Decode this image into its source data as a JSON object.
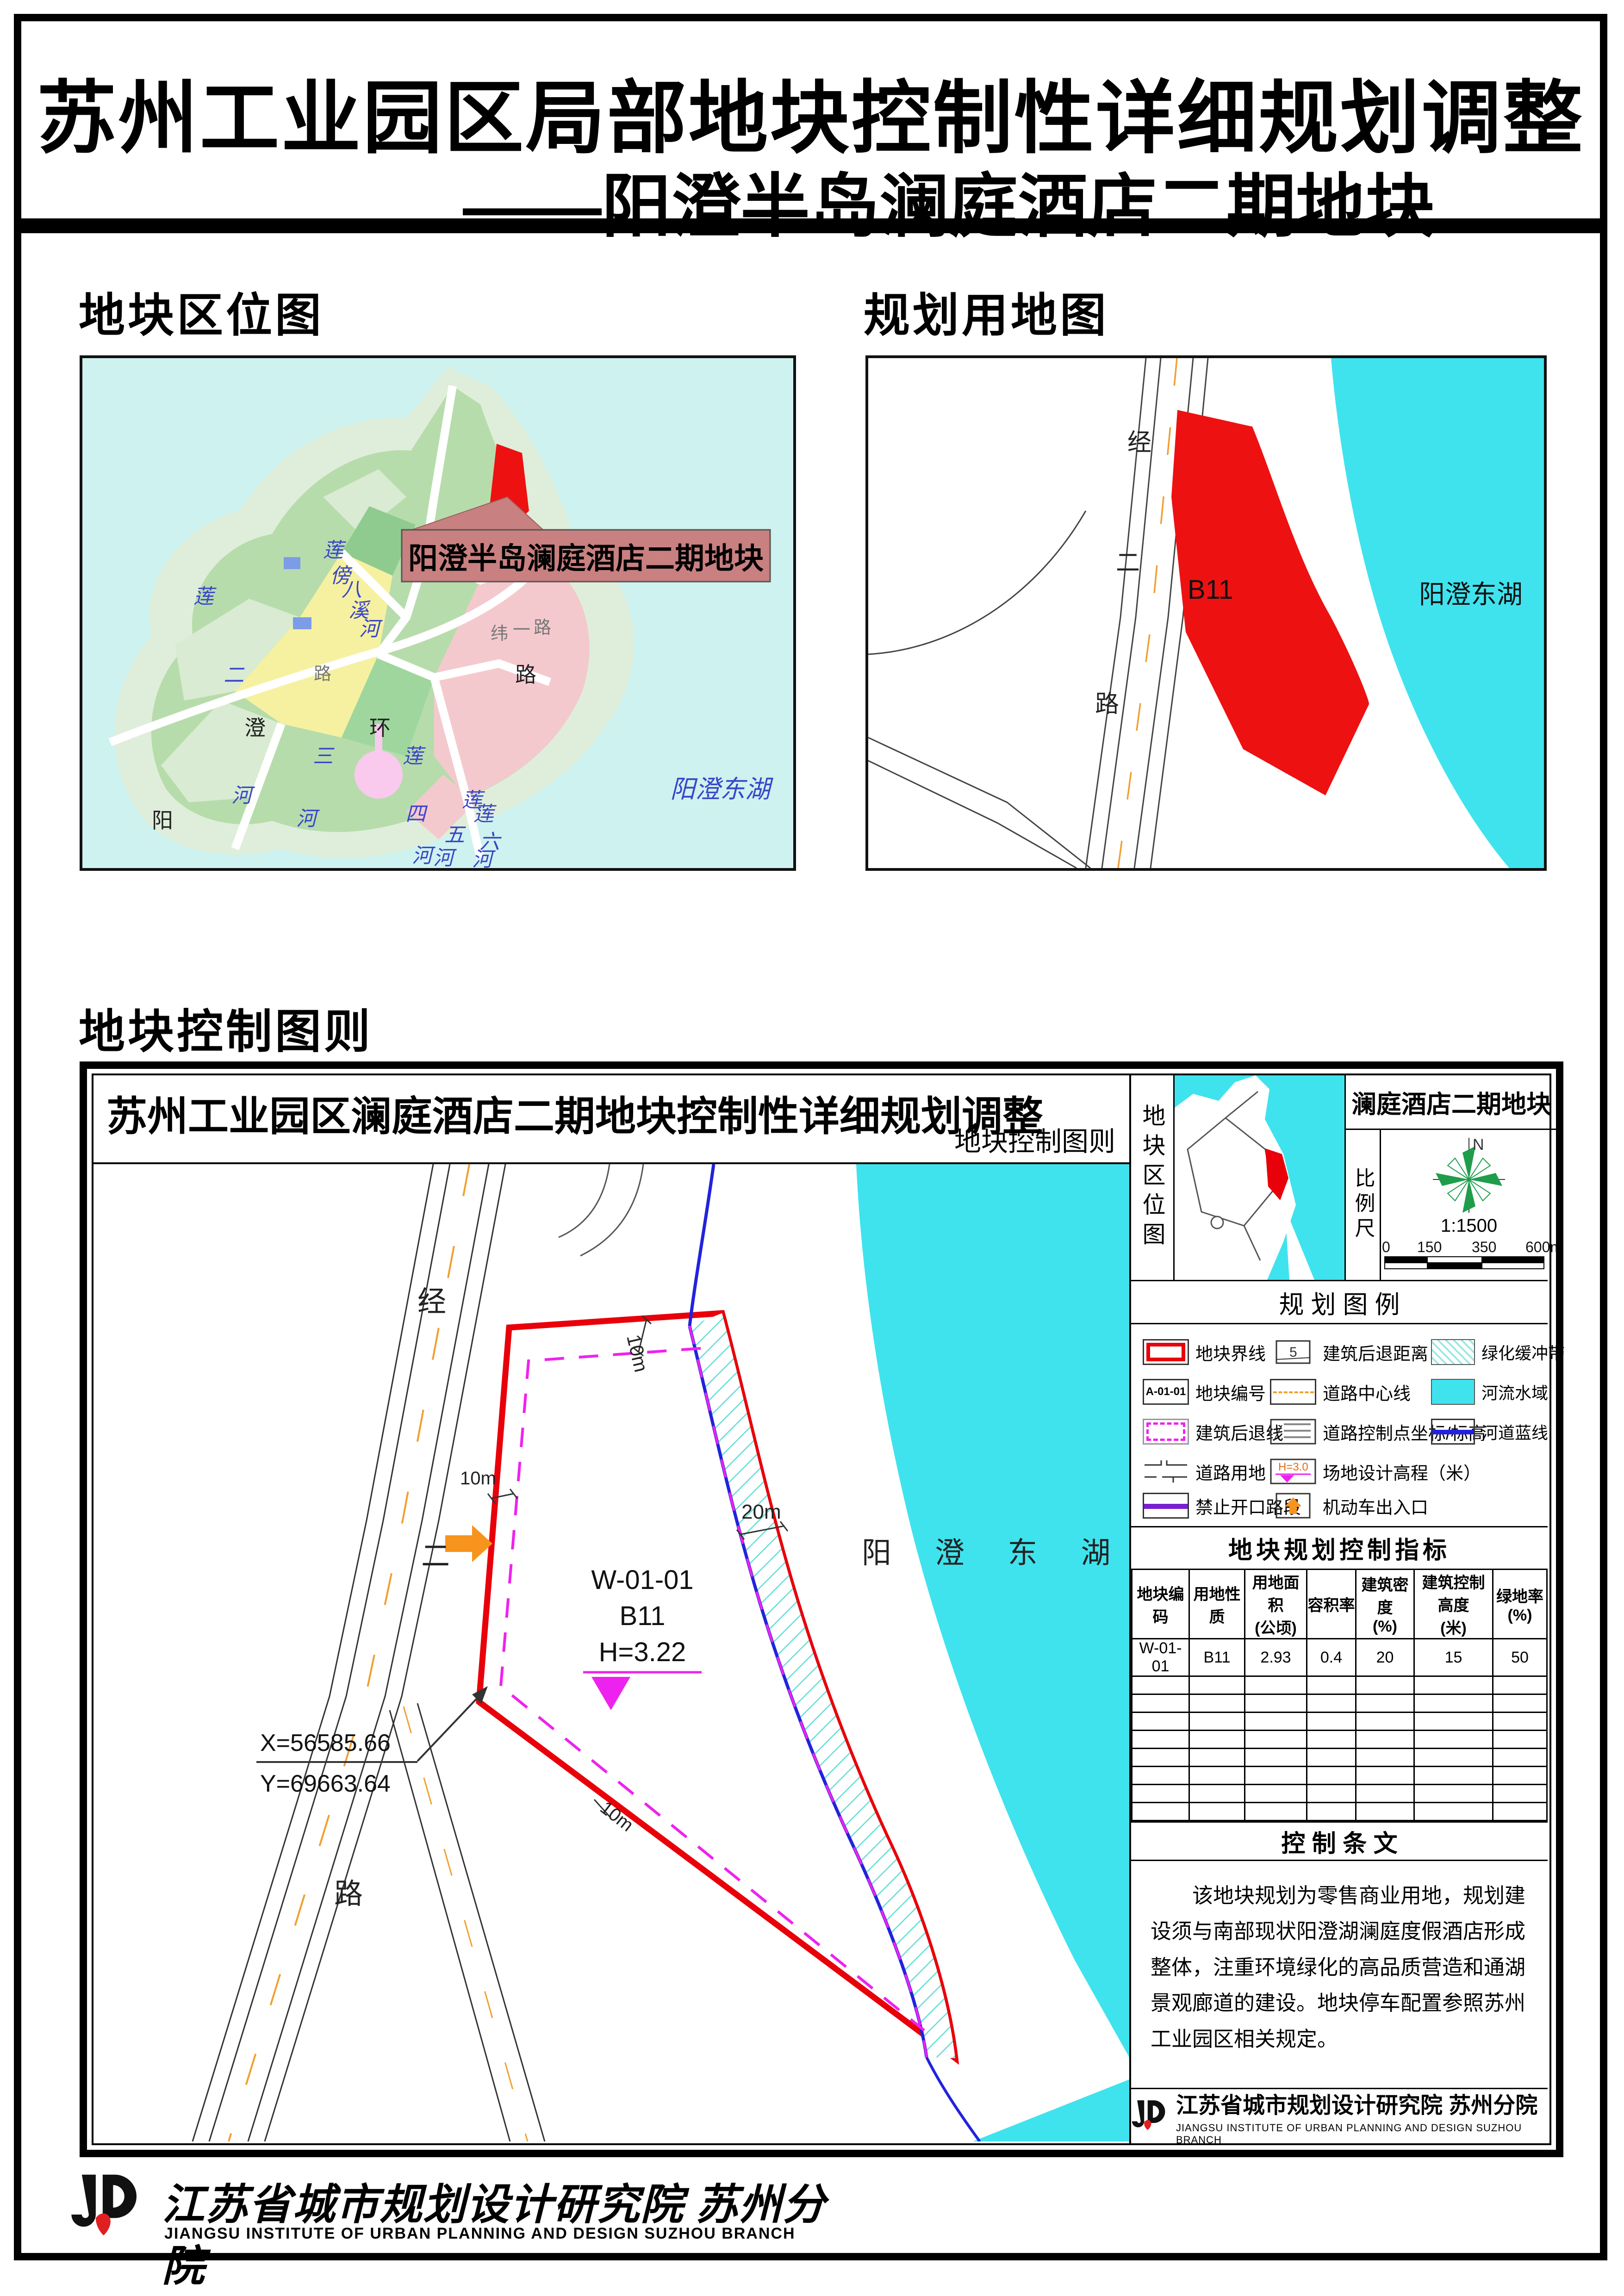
{
  "header": {
    "title_line1": "苏州工业园区局部地块控制性详细规划调整",
    "title_line2": "——阳澄半岛澜庭酒店二期地块"
  },
  "sections": {
    "location": "地块区位图",
    "landuse": "规划用地图",
    "control": "地块控制图则"
  },
  "location_map": {
    "label_box": "阳澄半岛澜庭酒店二期地块",
    "lake": "阳澄东湖",
    "ring_chars": [
      "阳",
      "澄",
      "环",
      "路"
    ],
    "river2": [
      "莲",
      "二",
      "河"
    ],
    "river3": [
      "三",
      "河"
    ],
    "river4": [
      "莲",
      "四",
      "河"
    ],
    "river5": [
      "莲",
      "五",
      "河"
    ],
    "river6": [
      "莲",
      "六",
      "河"
    ],
    "creek": [
      "莲",
      "傍",
      "八",
      "溪",
      "河"
    ],
    "wei_chars": [
      "纬",
      "一",
      "路"
    ],
    "extra_lu": "路"
  },
  "landuse_map": {
    "parcel": "B11",
    "lake": "阳澄东湖",
    "road_chars": [
      "经",
      "二",
      "路"
    ]
  },
  "control": {
    "header_title": "苏州工业园区澜庭酒店二期地块控制性详细规划调整",
    "header_right": "地块控制图则",
    "drawing": {
      "road_chars": [
        "经",
        "二",
        "路"
      ],
      "code": "W-01-01",
      "use": "B11",
      "elev": "H=3.22",
      "coord_x": "X=56585.66",
      "coord_y": "Y=69663.64",
      "lake": "阳 澄 东 湖",
      "dim_top": "10m",
      "dim_west": "10m",
      "dim_east": "20m",
      "dim_south": "10m"
    },
    "panel": {
      "thumb_label": "地块区位图",
      "title": "澜庭酒店二期地块",
      "scale_label": "比例尺",
      "north": "N",
      "ratio": "1:1500",
      "ticks": [
        "0",
        "150",
        "350",
        "600m"
      ],
      "legend_title": "规 划 图 例",
      "legend_col1": [
        "地块界线",
        "地块编号",
        "建筑后退线",
        "道路用地",
        "禁止开口路段"
      ],
      "legend_col2": [
        "建筑后退距离（米）",
        "道路中心线",
        "道路控制点坐标/标高",
        "场地设计高程（米）",
        "机动车出入口"
      ],
      "legend_col3": [
        "绿化缓冲带",
        "河流水域",
        "河道蓝线"
      ],
      "legend_parcel_code": "A-01-01",
      "legend_dim": "5",
      "legend_elev": "H=3.0",
      "table_title": "地块规划控制指标",
      "th1": [
        "地块编码",
        "用地性质",
        "用地面积",
        "容积率",
        "建筑密度",
        "建筑控制高度",
        "绿地率"
      ],
      "th2": [
        "",
        "",
        "(公顷)",
        "",
        "(%)",
        "(米)",
        "(%)"
      ],
      "row": [
        "W-01-01",
        "B11",
        "2.93",
        "0.4",
        "20",
        "15",
        "50"
      ],
      "provisions_title": "控 制 条 文",
      "provisions": "该地块规划为零售商业用地，规划建设须与南部现状阳澄湖澜庭度假酒店形成整体，注重环境绿化的高品质营造和通湖景观廊道的建设。地块停车配置参照苏州工业园区相关规定。",
      "inst_cn": "江苏省城市规划设计研究院 苏州分院",
      "inst_en": "JIANGSU INSTITUTE OF URBAN PLANNING AND DESIGN  SUZHOU BRANCH"
    }
  },
  "footer": {
    "inst_cn": "江苏省城市规划设计研究院 苏州分院",
    "inst_en": "JIANGSU INSTITUTE OF URBAN PLANNING AND DESIGN SUZHOU BRANCH"
  },
  "colors": {
    "water": "#3FE3EE",
    "parcel_red": "#E8000A",
    "setback_magenta": "#EE22EE",
    "river_blue": "#2222DD",
    "road_orange": "#F0A030",
    "no_access_purple": "#7A1FD0",
    "buffer_hatch": "#5FDED6",
    "label_pink": "#C98080"
  }
}
